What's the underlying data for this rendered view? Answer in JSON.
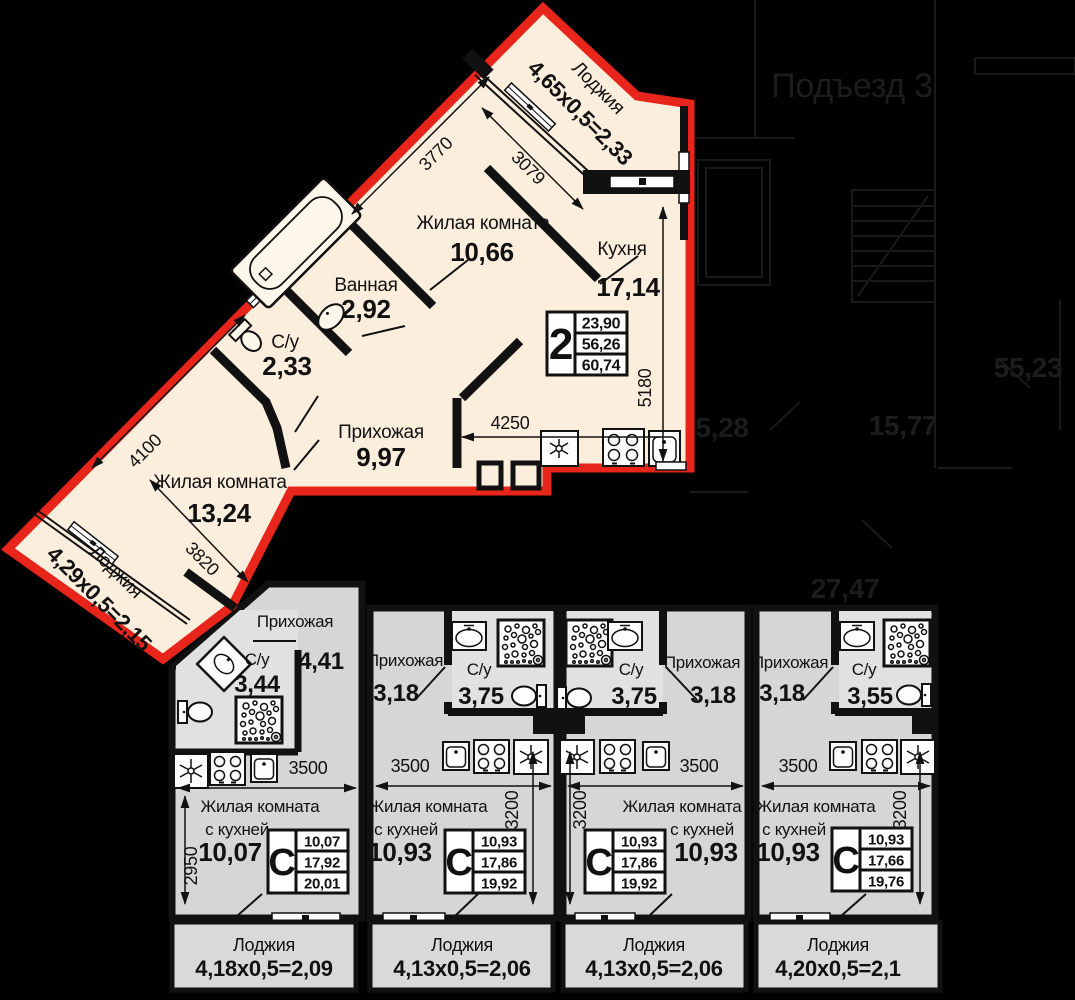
{
  "colors": {
    "background": "#000000",
    "highlight_outline": "#e8251b",
    "apartment_fill": "#fceedd",
    "studio_fill": "#d6d6d6",
    "wc_fill": "#e1e1e1",
    "loggia_fill": "#d9d9d9",
    "wall": "#111111"
  },
  "apartment": {
    "badge": "2",
    "rooms": {
      "living1": {
        "name": "Жилая комната",
        "area": "10,66"
      },
      "kitchen": {
        "name": "Кухня",
        "area": "17,14"
      },
      "bath": {
        "name": "Ванная",
        "area": "2,92"
      },
      "wc": {
        "name": "С/у",
        "area": "2,33"
      },
      "hall": {
        "name": "Прихожая",
        "area": "9,97"
      },
      "living2": {
        "name": "Жилая комната",
        "area": "13,24"
      },
      "loggia_top": {
        "name": "Лоджия",
        "formula": "4,65х0,5=2,33"
      },
      "loggia_left": {
        "name": "Лоджия",
        "formula": "4,29х0,5=2,15"
      }
    },
    "dims": {
      "living1_width": "3770",
      "living1_depth": "3079",
      "kitchen_width": "4250",
      "kitchen_depth": "5180",
      "living2_width": "4100",
      "living2_depth": "3820"
    },
    "table": {
      "rooms": "2",
      "living": "23,90",
      "area": "56,26",
      "total": "60,74"
    }
  },
  "studios": [
    {
      "hall_name": "Прихожая",
      "hall_area": "4,41",
      "wc_name": "С/у",
      "wc_area": "3,44",
      "living_line1": "Жилая комната",
      "living_line2": "с кухней",
      "living_area": "10,07",
      "table_letter": "С",
      "table_living": "10,07",
      "table_area": "17,92",
      "table_total": "20,01",
      "dim_width": "3500",
      "dim_depth": "2950",
      "loggia_name": "Лоджия",
      "loggia_formula": "4,18х0,5=2,09"
    },
    {
      "hall_name": "Прихожая",
      "hall_area": "3,18",
      "wc_name": "С/у",
      "wc_area": "3,75",
      "living_line1": "Жилая комната",
      "living_line2": "с кухней",
      "living_area": "10,93",
      "table_letter": "С",
      "table_living": "10,93",
      "table_area": "17,86",
      "table_total": "19,92",
      "dim_width": "3500",
      "dim_depth": "3200",
      "loggia_name": "Лоджия",
      "loggia_formula": "4,13х0,5=2,06"
    },
    {
      "hall_name": "Прихожая",
      "hall_area": "3,18",
      "wc_name": "С/у",
      "wc_area": "3,75",
      "living_line1": "Жилая комната",
      "living_line2": "с кухней",
      "living_area": "10,93",
      "table_letter": "С",
      "table_living": "10,93",
      "table_area": "17,86",
      "table_total": "19,92",
      "dim_width": "3500",
      "dim_depth": "3200",
      "loggia_name": "Лоджия",
      "loggia_formula": "4,13х0,5=2,06"
    },
    {
      "hall_name": "Прихожая",
      "hall_area": "3,18",
      "wc_name": "С/у",
      "wc_area": "3,55",
      "living_line1": "Жилая комната",
      "living_line2": "с кухней",
      "living_area": "10,93",
      "table_letter": "С",
      "table_living": "10,93",
      "table_area": "17,66",
      "table_total": "19,76",
      "dim_width": "3500",
      "dim_depth": "3200",
      "loggia_name": "Лоджия",
      "loggia_formula": "4,20х0,5=2,1"
    }
  ],
  "common": {
    "entrance": "Подъезд 3",
    "area1": "55,23",
    "area2": "5,28",
    "area3": "15,77",
    "area4": "27,47"
  }
}
